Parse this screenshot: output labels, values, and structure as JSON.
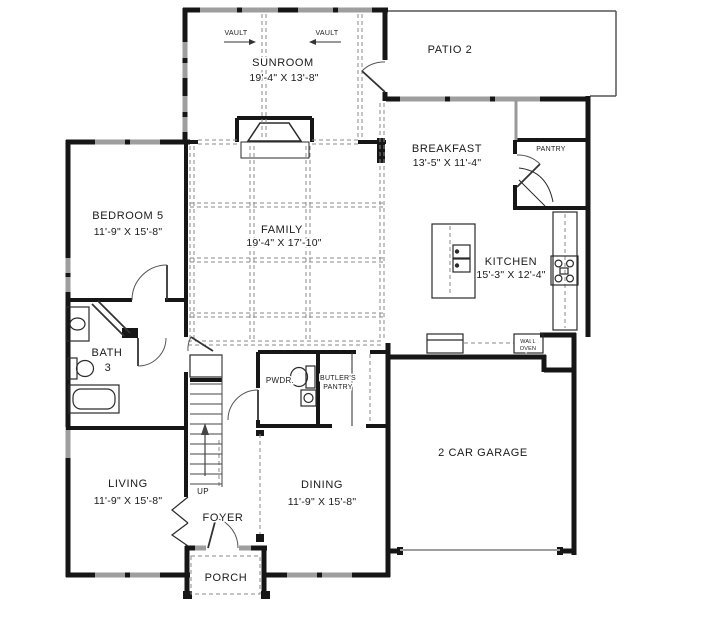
{
  "floorplan": {
    "rooms": {
      "sunroom": {
        "name": "SUNROOM",
        "dims": "19'-4\" X 13'-8\""
      },
      "patio": {
        "name": "PATIO 2"
      },
      "breakfast": {
        "name": "BREAKFAST",
        "dims": "13'-5\" X 11'-4\""
      },
      "pantry": {
        "name": "PANTRY"
      },
      "family": {
        "name": "FAMILY",
        "dims": "19'-4\" X 17'-10\""
      },
      "bedroom5": {
        "name": "BEDROOM 5",
        "dims": "11'-9\" X 15'-8\""
      },
      "kitchen": {
        "name": "KITCHEN",
        "dims": "15'-3\" X 12'-4\""
      },
      "bath3": {
        "name_line1": "BATH",
        "name_line2": "3"
      },
      "powder": {
        "name": "PWDR."
      },
      "butlers_pantry": {
        "name_line1": "BUTLER'S",
        "name_line2": "PANTRY"
      },
      "garage": {
        "name": "2 CAR GARAGE"
      },
      "living": {
        "name": "LIVING",
        "dims": "11'-9\" X 15'-8\""
      },
      "dining": {
        "name": "DINING",
        "dims": "11'-9\" X 15'-8\""
      },
      "foyer": {
        "name": "FOYER"
      },
      "porch": {
        "name": "PORCH"
      }
    },
    "annotations": {
      "vault_left": "VAULT",
      "vault_right": "VAULT",
      "stairs_up": "UP",
      "wall_oven_line1": "WALL",
      "wall_oven_line2": "OVEN"
    },
    "colors": {
      "wall": "#161616",
      "window": "#9e9e9e",
      "dashed": "#8a8a8a",
      "patio_outline": "#555555",
      "text": "#1a1a1a",
      "background": "#ffffff"
    }
  }
}
